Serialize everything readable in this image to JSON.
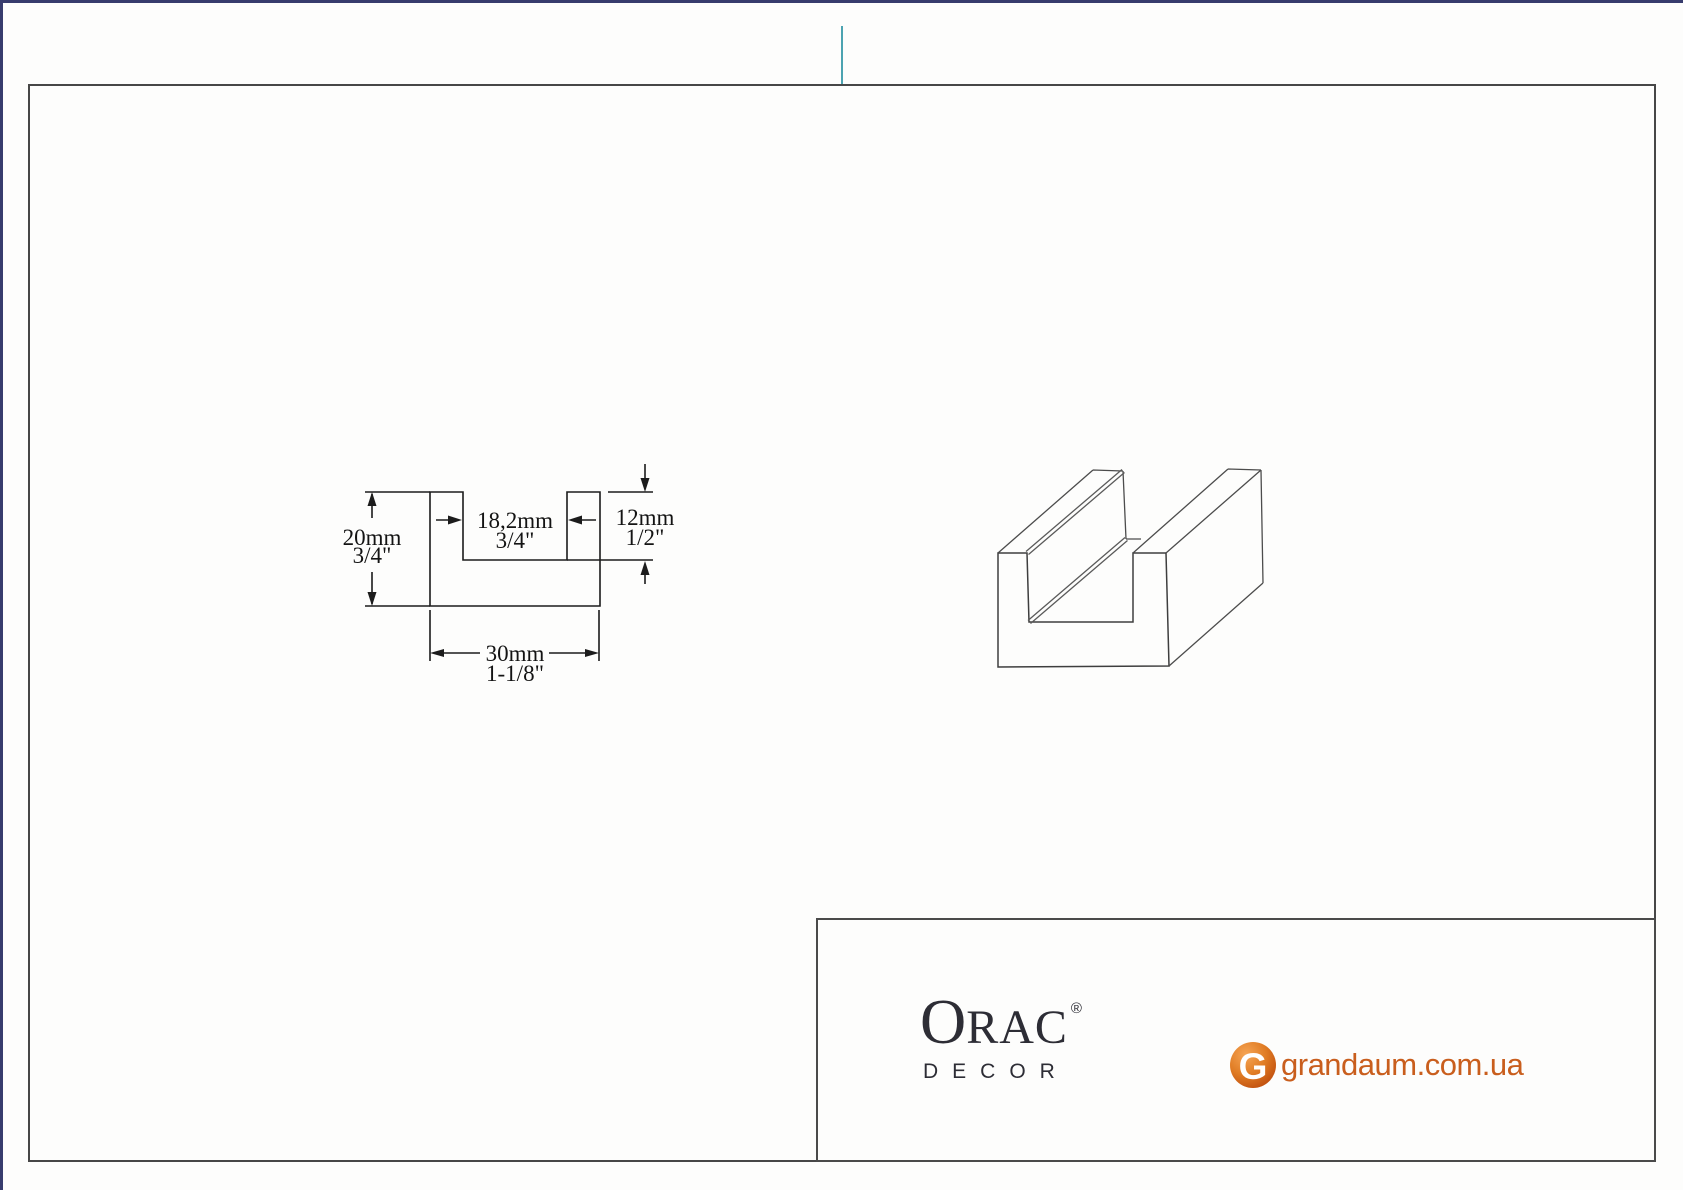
{
  "page": {
    "accent_border_color": "#373c6d",
    "frame_border_color": "#474747",
    "fold_mark_color": "#4ca3b1"
  },
  "cross_section": {
    "height_mm": "20mm",
    "height_in": "3/4\"",
    "inner_width_mm": "18,2mm",
    "inner_width_in": "3/4\"",
    "depth_mm": "12mm",
    "depth_in": "1/2\"",
    "width_mm": "30mm",
    "width_in": "1-1/8\""
  },
  "footer": {
    "orac_initial": "O",
    "orac_rest": "RAC",
    "orac_registered": "®",
    "orac_subtitle": "DECOR",
    "orac_color": "#2d2d35",
    "grandaum_initial": "G",
    "grandaum_domain": "grandaum.com.ua",
    "grandaum_color": "#c95e1d"
  }
}
